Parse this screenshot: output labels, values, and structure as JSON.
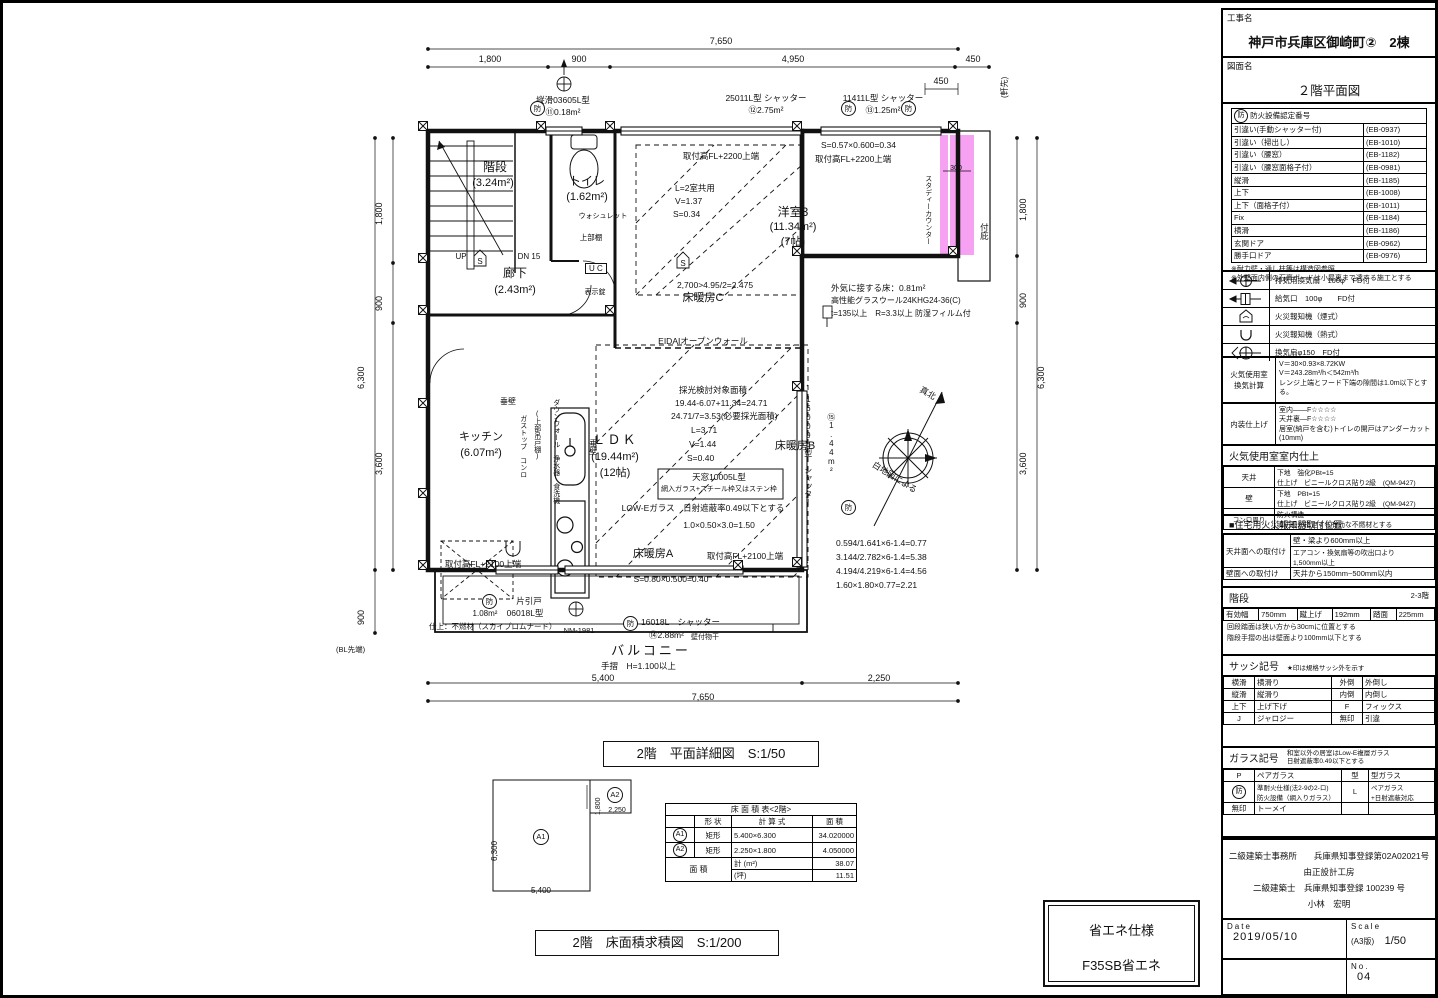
{
  "colors": {
    "highlight": "#F590EF",
    "line": "#111111"
  },
  "glyphs": {
    "bou": "防",
    "s": "S",
    "up": "UP",
    "dn": "DN 15",
    "uc": "U C",
    "a1": "A1",
    "a2": "A2"
  },
  "title_block": {
    "project_label": "工事名",
    "project_name": "神戸市兵庫区御崎町②　2棟",
    "drawing_label": "図面名",
    "drawing_name": "２階平面図"
  },
  "titles": {
    "plan": "2階　平面詳細図　S:1/50",
    "area": "2階　床面積求積図　S:1/200",
    "eco_line1": "省エネ仕様",
    "eco_line2": "F35SB省エネ"
  },
  "panel": {
    "fire": {
      "title": "防火設備認定番号",
      "rows": [
        {
          "name": "引違い(手動シャッター付)",
          "code": "(EB-0937)"
        },
        {
          "name": "引違い（掃出し）",
          "code": "(EB-1010)"
        },
        {
          "name": "引違い（腰窓）",
          "code": "(EB-1182)"
        },
        {
          "name": "引違い（腰窓面格子付）",
          "code": "(EB-0981)"
        },
        {
          "name": "縦滑",
          "code": "(EB-1185)"
        },
        {
          "name": "上下",
          "code": "(EB-1008)"
        },
        {
          "name": "上下（面格子付）",
          "code": "(EB-1011)"
        },
        {
          "name": "Fix",
          "code": "(EB-1184)"
        },
        {
          "name": "横滑",
          "code": "(EB-1186)"
        },
        {
          "name": "玄関ドア",
          "code": "(EB-0962)"
        },
        {
          "name": "勝手口ドア",
          "code": "(EB-0976)"
        }
      ],
      "notes": [
        "※耐力壁・通し柱等は構造図参照",
        "※外壁面内側の石膏ボードは小屋裏まで達する施工とする"
      ]
    },
    "legend": {
      "rows": [
        {
          "icon": "exhaust-fan-icon",
          "label": "排気用換気扇　100φ　FD付"
        },
        {
          "icon": "supply-vent-icon",
          "label": "給気口　100φ　　FD付"
        },
        {
          "icon": "smoke-detector-icon",
          "label": "火災報知機（煙式）"
        },
        {
          "icon": "heat-detector-icon",
          "label": "火災報知機（熱式）"
        },
        {
          "icon": "vent-fan-icon",
          "label": "換気扇φ150　FD付"
        }
      ]
    },
    "vent": {
      "label": "火気使用室\n換気計算",
      "lines": "V＝30×0.93×8.72KW\nV＝243.28m³/h＜542m³/h\nレンジ上端とフード下端の隙間は1.0m以下とする。"
    },
    "interior": {
      "label": "内装仕上げ",
      "lines": "室内——F☆☆☆☆\n天井裏—F☆☆☆☆\n居室(納戸を含む)トイレの開戸はアンダーカット(10mm)"
    },
    "room_finish": {
      "title": "火気使用室室内仕上",
      "rows": [
        {
          "part": "天井",
          "spec": "下地　強化PBt=15\n仕上げ　ビニールクロス貼り2級　(QM-9427)"
        },
        {
          "part": "壁",
          "spec": "下地　PBt=15\n仕上げ　ビニールクロス貼り2級　(QM-9427)"
        },
        {
          "part": "コンロ周り",
          "spec": "防火構造\n消防長が指定する有効な不燃材とする"
        }
      ]
    },
    "alarm": {
      "title": "■住宅用火災報知器取付位置",
      "ceiling_label": "天井面への取付け",
      "ceiling_v1": "壁・梁より600mm以上",
      "ceiling_v2": "エアコン・換気扇等の吹出口より\n1,500mm以上",
      "wall_label": "壁面への取付け",
      "wall_v": "天井から150mm~500mm以内"
    },
    "stairs": {
      "title": "階段",
      "floors": "2-3階",
      "c1": "有効幅",
      "v1": "750mm",
      "c2": "蹴上げ",
      "v2": "192mm",
      "c3": "踏面",
      "v3": "225mm",
      "notes": "回段踏面は狭い方から30cmに位置とする\n階段手摺の出は壁面より100mm以下とする"
    },
    "sash": {
      "title": "サッシ記号",
      "note": "★印は規格サッシ外を示す",
      "rows": [
        [
          "横滑",
          "横滑り",
          "外倒",
          "外倒し"
        ],
        [
          "縦滑",
          "縦滑り",
          "内倒",
          "内倒し"
        ],
        [
          "上下",
          "上げ下げ",
          "F",
          "フィックス"
        ],
        [
          "J",
          "ジャロジー",
          "無印",
          "引違"
        ]
      ]
    },
    "glass": {
      "title": "ガラス記号",
      "note": "和室以外の居室はLow-E複層ガラス\n日射遮蔽率0.49以下とする",
      "rows": [
        [
          "P",
          "ペアガラス",
          "型",
          "型ガラス"
        ],
        [
          "防",
          "準耐火仕様(法2-9の2-ロ)\n防火設備（網入りガラス）",
          "L",
          "ペアガラス\n+日射遮蔽対応"
        ],
        [
          "無印",
          "トーメイ",
          "",
          ""
        ]
      ]
    },
    "office": {
      "line1": "二級建築士事務所　　兵庫県知事登録第02A02021号",
      "line2": "由正設計工房",
      "line3": "二級建築士　兵庫県知事登録 100239 号",
      "line4": "小林　宏明",
      "date_label": "Date",
      "date": "2019/05/10",
      "scale_label": "Scale",
      "scale_paper": "(A3版)",
      "scale": "1/50",
      "no_label": "No.",
      "no": "04"
    }
  },
  "plan": {
    "labels": {
      "t7650": "7,650",
      "t1800": "1,800",
      "t900": "900",
      "t4950": "4,950",
      "t450a": "450",
      "t450b": "450",
      "nokisaki": "(軒先)",
      "w11": "縦滑03605L型",
      "w11b": "⑪0.18m²",
      "w12": "25011L型 シャッター",
      "w12b": "⑫2.75m²",
      "w13": "11411L型 シャッター",
      "w13b": "⑬1.25m²",
      "s057": "S=0.57×0.600=0.34",
      "fl2200r": "取付高FL+2200上端",
      "d300": "300",
      "study": "スタディーカウンター",
      "hisashi": "付庇",
      "kaidan": "階段",
      "kaidan_a": "(3.24m²)",
      "toilet": "トイレ",
      "toilet_a": "(1.62m²)",
      "washlet": "ウォシュレット",
      "jobudana": "上部棚",
      "rouka": "廊下",
      "rouka_a": "(2.43m²)",
      "hyojijo": "表示錠",
      "fl2200l": "取付高FL+2200上端",
      "l2room": "L=2室共用",
      "v137": "V=1.37",
      "s034": "S=0.34",
      "yo3": "洋室3",
      "yo3a": "(11.34m²)",
      "yo3j": "(7帖)",
      "c2700": "2,700>4.95/2=2.475",
      "yukaC": "床暖房C",
      "gaiki1": "外気に接する床：0.81m²",
      "gaiki2": "高性能グラスウール24KHG24-36(C)",
      "gaiki3": "t=135以上　R=3.3以上 防湿フィルム付",
      "eidai": "EIDAIオープンウォール",
      "sai1": "採光検討対象面積",
      "sai2": "19.44-6.07+11.34=24.71",
      "sai3": "24.71/7=3.53(必要採光面積)",
      "l371": "L=3.71",
      "v144": "V=1.44",
      "s040": "S=0.40",
      "ldk": "ＬＤＫ",
      "ldk_a": "(19.44m²)",
      "ldk_j": "(12帖)",
      "yukaB": "床暖房B",
      "tenmado1": "天窓10005L型",
      "tenmado2": "網入ガラス+スチール枠又はステン枠",
      "lowe": "LOW-Eガラス　日射遮蔽率0.49以下とする",
      "c150": "1.0×0.50×3.0=1.50",
      "yukaA": "床暖房A",
      "fl2100b": "取付高FL+2100上端",
      "s080": "S=0.80×0.500=0.40",
      "kitchen": "キッチン",
      "kitchen_a": "(6.07m²)",
      "tare1": "垂壁",
      "gastop": "ガストップ コンロ",
      "tsurido": "(上部吊戸棚)",
      "dwall": "ダウンウォール 浄水器 食洗機",
      "tare2": "垂壁",
      "fl2100a": "取付高FL+2100上端",
      "kata1": "片引戸",
      "kata2": "06018L型",
      "kata_a": "1.08m²",
      "kata_f": "仕上：不燃材（スカイプロムナード）",
      "nm": "NM-1981",
      "sh18": "16018L　シャッター",
      "sh18b": "⑭2.88m²",
      "monohoshi": "壁付物干",
      "balcony": "バルコニー",
      "tesuri": "手摺　H=1.100以上",
      "b5400": "5,400",
      "b2250": "2,250",
      "b7650": "7,650",
      "sh09": "16009L型 シャッター",
      "sh09b": "⑮1.44m²",
      "rc1": "0.594/1.641×6-1.4=0.77",
      "rc2": "3.144/2.782×6-1.4=5.38",
      "rc3": "4.194/4.219×6-1.4=4.56",
      "rc4": "1.60×1.80×0.77=2.21",
      "north": "真北",
      "shirachizu": "白地図による",
      "lv1800": "1,800",
      "lv900a": "900",
      "lv3600": "3,600",
      "lv6300": "6,300",
      "lv900b": "900",
      "bl": "(BL先端)",
      "rv1800": "1,800",
      "rv900": "900",
      "rv6300": "6,300",
      "rv3600": "3,600"
    }
  },
  "area_diagram": {
    "d6300": "6,300",
    "d5400": "5,400",
    "d1800": "1,800",
    "d2250": "2,250"
  },
  "floor_table": {
    "title": "床 面 積 表<2階>",
    "h_shape": "形 状",
    "h_formula": "計 算 式",
    "h_area": "面 積",
    "rows": [
      {
        "mark": "A1",
        "shape": "矩形",
        "formula": "5.400×6.300",
        "area": "34.020000"
      },
      {
        "mark": "A2",
        "shape": "矩形",
        "formula": "2.250×1.800",
        "area": "4.050000"
      }
    ],
    "total_label": "面 積",
    "total_m2_label": "計 (m²)",
    "total_m2": "38.07",
    "tsubo_label": "(坪)",
    "tsubo": "11.51"
  }
}
